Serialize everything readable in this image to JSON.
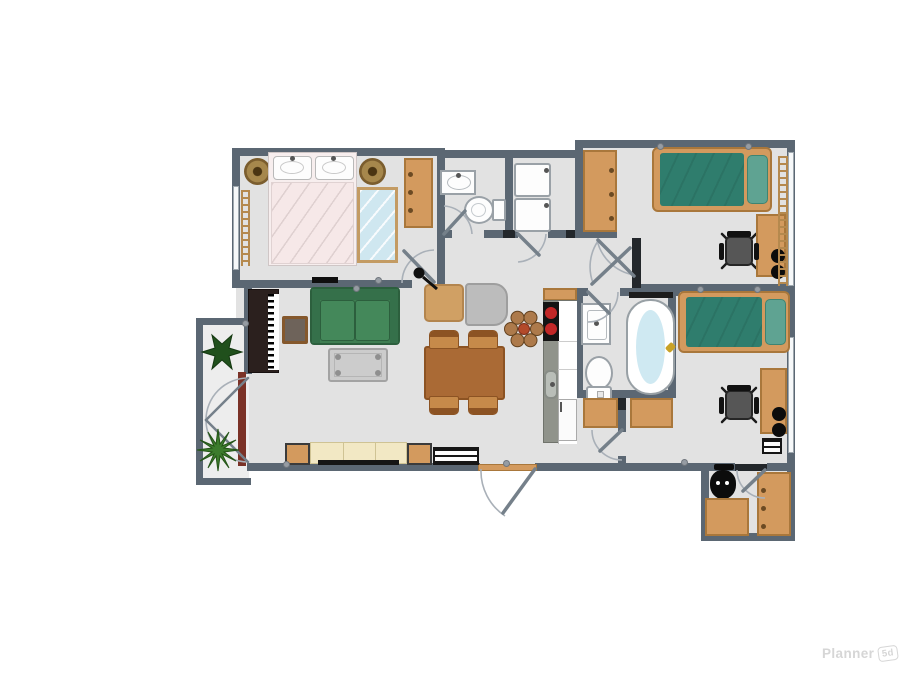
{
  "watermark": {
    "brand": "Planner",
    "badge": "5d"
  },
  "colors": {
    "wall": "#5b6773",
    "wallDark": "#23272b",
    "floor": "#e2e2e2",
    "floor2": "#ededed",
    "orange": "#d39a5e",
    "orangeDark": "#a9773b",
    "handle": "#6b4a23",
    "teal": "#2f7d6d",
    "tealLight": "#5fa392",
    "green": "#3f7e52",
    "greenDark": "#2c5f3d",
    "greenMid": "#44885a",
    "cream": "#f2e8c4",
    "creamDark": "#cfc394",
    "tableBrown": "#aa6a35",
    "tableBrownDark": "#8c5323",
    "chairBrown": "#c68a4a",
    "grayChair": "#bcbcbc",
    "grayTable": "#cccccc",
    "red": "#c22727",
    "water": "#cfe9f2",
    "mirror": "#cfe7f0",
    "mirrorFrame": "#c39b63",
    "panelRed": "#7b3227",
    "plantDark": "#20501c",
    "plantLight": "#3c7c2d",
    "petal": "#ad7a4b",
    "petalCenter": "#b34a2a",
    "doorLeaf": "#75808a",
    "doorArc": "#a9b0b8",
    "counter": "#90938b",
    "ladder": "#b5894e",
    "gold": "#c9a227",
    "seatGray": "#565656",
    "benchTop": "#6e635a",
    "benchFrame": "#85582c",
    "pianoDark": "#2b201e",
    "bedBase": "#f7eeee",
    "blanketPink": "#f6e8e8",
    "watermark": "#d6d6d6"
  },
  "plan": {
    "rooms": [
      {
        "name": "master-bedroom",
        "furniture": [
          "double-bed",
          "pillows",
          "mirror",
          "wardrobe",
          "round-rug-left",
          "round-rug-right",
          "radiator",
          "window",
          "wall-tv"
        ]
      },
      {
        "name": "wc",
        "furniture": [
          "sink",
          "toilet"
        ]
      },
      {
        "name": "laundry",
        "furniture": [
          "washer",
          "dryer"
        ]
      },
      {
        "name": "bedroom-1",
        "furniture": [
          "single-bed",
          "wardrobe",
          "desk",
          "office-chair",
          "speakers",
          "radiator",
          "window"
        ]
      },
      {
        "name": "bathroom",
        "furniture": [
          "sink",
          "bathtub",
          "shower-rail",
          "toilet"
        ]
      },
      {
        "name": "kitchen",
        "furniture": [
          "upper-cabinet",
          "stove",
          "counter",
          "sink",
          "fridge"
        ]
      },
      {
        "name": "living-dining",
        "furniture": [
          "piano",
          "piano-bench",
          "sofa",
          "coffee-table",
          "armchair-tan",
          "armchair-gray",
          "floor-lamp",
          "dining-table",
          "dining-chairs",
          "sideboard",
          "side-tables",
          "radiator",
          "flower-decor",
          "entry-door"
        ]
      },
      {
        "name": "bedroom-2",
        "furniture": [
          "single-bed",
          "desk",
          "office-chair",
          "speakers",
          "dresser",
          "hall-cabinet",
          "radiator",
          "window"
        ]
      },
      {
        "name": "storage",
        "furniture": [
          "vacuum",
          "desk",
          "wardrobe"
        ]
      },
      {
        "name": "balcony",
        "furniture": [
          "plant-star",
          "plant-spiky",
          "french-doors",
          "door-panel"
        ]
      }
    ]
  }
}
